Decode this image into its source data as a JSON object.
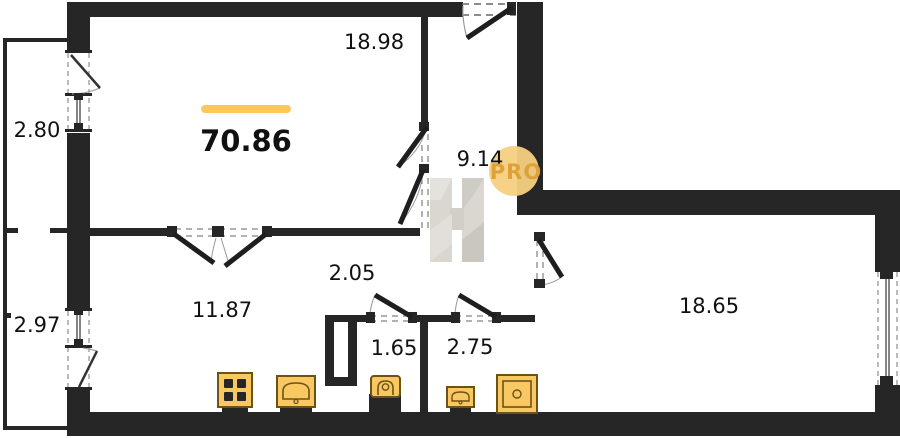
{
  "plan": {
    "title": "apartment-floor-plan",
    "total_area": "70.86",
    "rooms": [
      {
        "id": "living-room",
        "area": "18.98"
      },
      {
        "id": "hall",
        "area": "9.14"
      },
      {
        "id": "balcony-top",
        "area": "2.80"
      },
      {
        "id": "balcony-bottom",
        "area": "2.97"
      },
      {
        "id": "kitchen",
        "area": "11.87"
      },
      {
        "id": "corridor",
        "area": "2.05"
      },
      {
        "id": "wc",
        "area": "1.65"
      },
      {
        "id": "bathroom",
        "area": "2.75"
      },
      {
        "id": "bedroom",
        "area": "18.65"
      }
    ],
    "watermark": {
      "badge_text": "PRO",
      "letter": "H"
    },
    "icons": [
      "stove-icon",
      "kitchen-sink-icon",
      "toilet-icon",
      "washbasin-icon",
      "shower-icon"
    ],
    "colors": {
      "wall": "#262626",
      "accent": "#FBC85C",
      "icon_fill": "#F9C863",
      "icon_stroke": "#6b5314",
      "badge_fill": "#F5D080",
      "badge_text": "#DFA139",
      "watermark_gray": "#D7D3CD"
    }
  }
}
